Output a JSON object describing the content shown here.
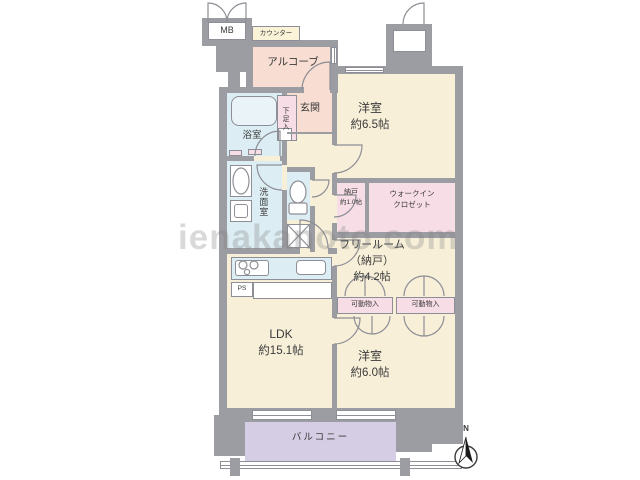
{
  "floorplan": {
    "watermark": "ienakanoto.com",
    "compass": {
      "north_label": "N"
    },
    "rooms": {
      "meter_box": {
        "label": "MB"
      },
      "counter": {
        "label": "カウンター"
      },
      "alcove": {
        "label": "アルコーブ"
      },
      "genkan": {
        "label": "玄関"
      },
      "shoe_cabinet": {
        "label": "下足入"
      },
      "bathroom": {
        "label": "浴室"
      },
      "washroom": {
        "label": "洗面室"
      },
      "western_room_1": {
        "label": "洋室",
        "size": "約6.5帖"
      },
      "storage_1": {
        "label": "納戸",
        "size": "約1.0帖"
      },
      "walk_in_closet": {
        "label_line1": "ウォークイン",
        "label_line2": "クロゼット"
      },
      "free_room": {
        "label": "フリールーム",
        "label_sub": "（納戸）",
        "size": "約4.2帖"
      },
      "movable_storage_1": {
        "label": "可動物入"
      },
      "movable_storage_2": {
        "label": "可動物入"
      },
      "ldk": {
        "label": "LDK",
        "size": "約15.1帖"
      },
      "western_room_2": {
        "label": "洋室",
        "size": "約6.0帖"
      },
      "balcony": {
        "label": "バルコニー"
      },
      "pipe_space": {
        "label": "PS"
      }
    }
  }
}
